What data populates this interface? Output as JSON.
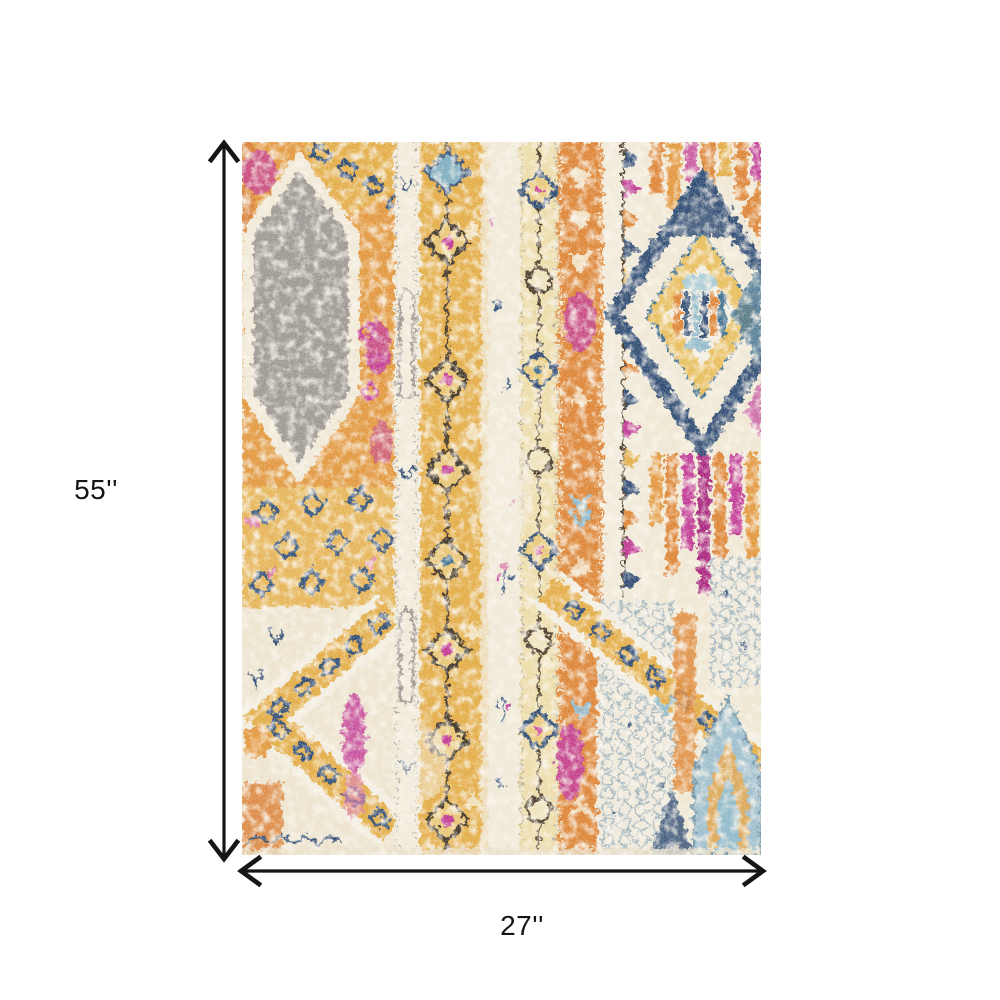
{
  "dimensions": {
    "height_label": "55''",
    "width_label": "27''"
  },
  "product": {
    "description": "Distressed bohemian tribal area rug with vertical stripes, diamond medallions, hexagon, chain motifs and arch",
    "palette": {
      "cream": "#EFE7D3",
      "saffron": "#E2973C",
      "orange": "#DD8434",
      "gold": "#E3AC45",
      "navy": "#2F4B73",
      "magenta": "#C13895",
      "gray": "#9C9792",
      "teal": "#8FB9CB",
      "arrow_black": "#151515"
    }
  }
}
